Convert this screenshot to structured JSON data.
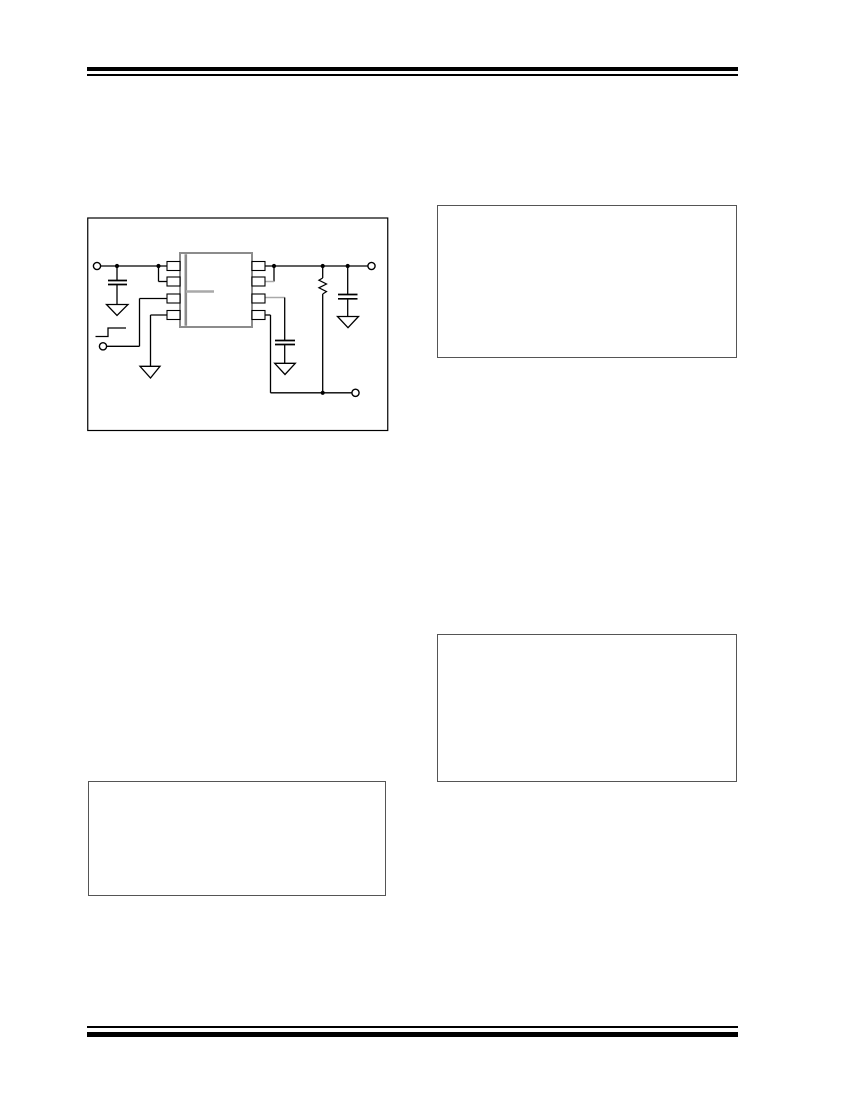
{
  "page": {
    "width": 849,
    "height": 1099,
    "background": "#ffffff"
  },
  "header_rule": {
    "color": "#000000",
    "thick": {
      "x": 87,
      "y": 66.5,
      "w": 651,
      "h": 4.6
    },
    "thin": {
      "x": 87,
      "y": 74.2,
      "w": 651,
      "h": 1.7
    }
  },
  "footer_rule": {
    "color": "#000000",
    "thin": {
      "x": 87,
      "y": 1026.3,
      "w": 651,
      "h": 1.7
    },
    "thick": {
      "x": 87,
      "y": 1031.6,
      "w": 651,
      "h": 5
    }
  },
  "placeholder_boxes": [
    {
      "name": "placeholder-box-top-right",
      "x": 437,
      "y": 205,
      "w": 300,
      "h": 153,
      "border_color": "#555555",
      "border_w": 1.6
    },
    {
      "name": "placeholder-box-middle-right",
      "x": 437,
      "y": 634,
      "w": 300,
      "h": 148,
      "border_color": "#555555",
      "border_w": 1.6
    },
    {
      "name": "placeholder-box-bottom-left",
      "x": 88,
      "y": 781,
      "w": 298,
      "h": 115,
      "border_color": "#555555",
      "border_w": 1.6
    }
  ],
  "figure": {
    "name": "typical-application-circuit",
    "frame": {
      "x": 87,
      "y": 217,
      "w": 302,
      "h": 215
    },
    "colors": {
      "line": "#000000",
      "ic": "#8c8c8c",
      "ghost": "#a9a9a9",
      "fill": "#ffffff"
    },
    "primitives": [
      {
        "n": "figure-frame",
        "t": "rect",
        "x": 0.75,
        "y": 1,
        "w": 300,
        "h": 212.5,
        "stroke": "line",
        "sw": 1.2,
        "fill": "none"
      },
      {
        "n": "wire-input",
        "t": "line",
        "x1": 13.6,
        "y1": 49,
        "x2": 80.6,
        "y2": 49,
        "stroke": "line",
        "sw": 1.3
      },
      {
        "n": "wire-pin2-horizontal",
        "t": "line",
        "x1": 71.5,
        "y1": 64.5,
        "x2": 80.6,
        "y2": 64.5,
        "stroke": "line",
        "sw": 1.3
      },
      {
        "n": "wire-pin2-vertical",
        "t": "line",
        "x1": 71.5,
        "y1": 49,
        "x2": 71.5,
        "y2": 64.5,
        "stroke": "line",
        "sw": 1.3
      },
      {
        "n": "wire-cin-upper-lead",
        "t": "line",
        "x1": 30,
        "y1": 49,
        "x2": 30,
        "y2": 63.5,
        "stroke": "line",
        "sw": 1.3
      },
      {
        "n": "wire-cin-lower-lead",
        "t": "line",
        "x1": 30,
        "y1": 67.5,
        "x2": 30,
        "y2": 87.5,
        "stroke": "line",
        "sw": 1.3
      },
      {
        "n": "wire-pin3-horizontal",
        "t": "line",
        "x1": 52.5,
        "y1": 81.5,
        "x2": 80.6,
        "y2": 81.5,
        "stroke": "line",
        "sw": 1.3
      },
      {
        "n": "wire-pin3-vertical",
        "t": "line",
        "x1": 52.5,
        "y1": 81.5,
        "x2": 52.5,
        "y2": 129.3,
        "stroke": "line",
        "sw": 1.3
      },
      {
        "n": "wire-enable",
        "t": "line",
        "x1": 19.6,
        "y1": 129.3,
        "x2": 52.5,
        "y2": 129.3,
        "stroke": "line",
        "sw": 1.3
      },
      {
        "n": "wire-pin4-horizontal",
        "t": "line",
        "x1": 63.5,
        "y1": 98,
        "x2": 80.6,
        "y2": 98,
        "stroke": "line",
        "sw": 1.3
      },
      {
        "n": "wire-pin4-vertical",
        "t": "line",
        "x1": 63.5,
        "y1": 98,
        "x2": 63.5,
        "y2": 149.3,
        "stroke": "line",
        "sw": 1.3
      },
      {
        "n": "wire-output",
        "t": "line",
        "x1": 177.4,
        "y1": 49,
        "x2": 280.9,
        "y2": 49,
        "stroke": "line",
        "sw": 1.3
      },
      {
        "n": "wire-pin7-vertical",
        "t": "line",
        "x1": 187,
        "y1": 49,
        "x2": 187,
        "y2": 64.5,
        "stroke": "line",
        "sw": 1.3
      },
      {
        "n": "wire-pin7-horizontal",
        "t": "line",
        "x1": 177.4,
        "y1": 64.5,
        "x2": 187,
        "y2": 64.5,
        "stroke": "ghost",
        "sw": 1.5
      },
      {
        "n": "wire-pin6-horizontal",
        "t": "line",
        "x1": 177.4,
        "y1": 80.5,
        "x2": 197.7,
        "y2": 80.5,
        "stroke": "ghost",
        "sw": 1.5
      },
      {
        "n": "wire-pin6-vertical",
        "t": "line",
        "x1": 197.7,
        "y1": 80.5,
        "x2": 197.7,
        "y2": 123.5,
        "stroke": "line",
        "sw": 1.3
      },
      {
        "n": "wire-cbyp-lower-lead",
        "t": "line",
        "x1": 197.7,
        "y1": 127.5,
        "x2": 197.7,
        "y2": 146.3,
        "stroke": "line",
        "sw": 1.3
      },
      {
        "n": "wire-pin5-horizontal",
        "t": "line",
        "x1": 177.4,
        "y1": 98,
        "x2": 183.5,
        "y2": 98,
        "stroke": "line",
        "sw": 1.3
      },
      {
        "n": "wire-pin5-vertical",
        "t": "line",
        "x1": 183.5,
        "y1": 98,
        "x2": 183.5,
        "y2": 175.8,
        "stroke": "line",
        "sw": 1.3
      },
      {
        "n": "wire-sense-bottom",
        "t": "line",
        "x1": 183.5,
        "y1": 175.8,
        "x2": 264.9,
        "y2": 175.8,
        "stroke": "line",
        "sw": 1.3
      },
      {
        "n": "wire-resistor-upper-lead",
        "t": "line",
        "x1": 235.7,
        "y1": 49,
        "x2": 235.7,
        "y2": 61,
        "stroke": "line",
        "sw": 1.3
      },
      {
        "n": "wire-resistor-lower-lead",
        "t": "line",
        "x1": 235.7,
        "y1": 77,
        "x2": 235.7,
        "y2": 175.8,
        "stroke": "line",
        "sw": 1.3
      },
      {
        "n": "wire-cout-upper-lead",
        "t": "line",
        "x1": 260.7,
        "y1": 49,
        "x2": 260.7,
        "y2": 77.5,
        "stroke": "line",
        "sw": 1.3
      },
      {
        "n": "wire-cout-lower-lead",
        "t": "line",
        "x1": 260.7,
        "y1": 81.8,
        "x2": 260.7,
        "y2": 99.5,
        "stroke": "line",
        "sw": 1.3
      },
      {
        "n": "step-input-symbol",
        "t": "poly",
        "closed": false,
        "pts": [
          [
            8.5,
            119.5
          ],
          [
            21,
            119.5
          ],
          [
            21,
            111
          ],
          [
            39,
            111
          ]
        ],
        "stroke": "line",
        "sw": 1.3,
        "fill": "none"
      },
      {
        "n": "resistor-zigzag",
        "t": "poly",
        "closed": false,
        "pts": [
          [
            235.7,
            61
          ],
          [
            231.9,
            63.2
          ],
          [
            239.5,
            67
          ],
          [
            231.9,
            70.8
          ],
          [
            239.5,
            74.6
          ],
          [
            235.7,
            77
          ]
        ],
        "stroke": "line",
        "sw": 1.2,
        "fill": "none"
      },
      {
        "n": "cin-plate-top",
        "t": "line",
        "x1": 21,
        "y1": 63.5,
        "x2": 40,
        "y2": 63.5,
        "stroke": "line",
        "sw": 1.7
      },
      {
        "n": "cin-plate-bottom",
        "t": "line",
        "x1": 21,
        "y1": 67.5,
        "x2": 40,
        "y2": 67.5,
        "stroke": "line",
        "sw": 1.7
      },
      {
        "n": "cout-plate-top",
        "t": "line",
        "x1": 251,
        "y1": 77.5,
        "x2": 270.5,
        "y2": 77.5,
        "stroke": "line",
        "sw": 1.7
      },
      {
        "n": "cout-plate-bottom",
        "t": "line",
        "x1": 251,
        "y1": 81.8,
        "x2": 270.5,
        "y2": 81.8,
        "stroke": "line",
        "sw": 1.7
      },
      {
        "n": "cbyp-plate-top",
        "t": "line",
        "x1": 188,
        "y1": 123.5,
        "x2": 208,
        "y2": 123.5,
        "stroke": "line",
        "sw": 1.7
      },
      {
        "n": "cbyp-plate-bottom",
        "t": "line",
        "x1": 188,
        "y1": 127.5,
        "x2": 208,
        "y2": 127.5,
        "stroke": "line",
        "sw": 1.7
      },
      {
        "n": "ground-symbol-input",
        "t": "poly",
        "closed": true,
        "pts": [
          [
            19.5,
            87.5
          ],
          [
            41,
            87.5
          ],
          [
            30,
            98.5
          ]
        ],
        "stroke": "line",
        "sw": 1.3,
        "fill": "fill"
      },
      {
        "n": "ground-symbol-output",
        "t": "poly",
        "closed": true,
        "pts": [
          [
            250.5,
            99.5
          ],
          [
            271.5,
            99.5
          ],
          [
            261,
            110.7
          ]
        ],
        "stroke": "line",
        "sw": 1.3,
        "fill": "fill"
      },
      {
        "n": "ground-symbol-bypass",
        "t": "poly",
        "closed": true,
        "pts": [
          [
            187.7,
            146.3
          ],
          [
            208.3,
            146.3
          ],
          [
            198,
            157.5
          ]
        ],
        "stroke": "line",
        "sw": 1.3,
        "fill": "fill"
      },
      {
        "n": "ground-symbol-gnd-pin",
        "t": "poly",
        "closed": true,
        "pts": [
          [
            53,
            149.3
          ],
          [
            73,
            149.3
          ],
          [
            63.5,
            161
          ]
        ],
        "stroke": "line",
        "sw": 1.3,
        "fill": "fill"
      },
      {
        "n": "ic-body",
        "t": "rect",
        "x": 93,
        "y": 36,
        "w": 72,
        "h": 74,
        "stroke": "ic",
        "sw": 2,
        "fill": "fill"
      },
      {
        "n": "ic-pin1-edge-bar",
        "t": "line",
        "x1": 98.8,
        "y1": 37.2,
        "x2": 98.8,
        "y2": 108.8,
        "stroke": "ic",
        "sw": 2.6
      },
      {
        "n": "ic-label-ghost",
        "t": "line",
        "x1": 99,
        "y1": 74.5,
        "x2": 127,
        "y2": 74.5,
        "stroke": "ghost",
        "sw": 2.6
      },
      {
        "n": "ic-pin-1",
        "t": "rect",
        "x": 80,
        "y": 44.5,
        "w": 13,
        "h": 9,
        "stroke": "line",
        "sw": 1.1,
        "fill": "fill"
      },
      {
        "n": "ic-pin-2",
        "t": "rect",
        "x": 80,
        "y": 60,
        "w": 13,
        "h": 9,
        "stroke": "line",
        "sw": 1.1,
        "fill": "fill"
      },
      {
        "n": "ic-pin-3",
        "t": "rect",
        "x": 80,
        "y": 77,
        "w": 13,
        "h": 9,
        "stroke": "line",
        "sw": 1.1,
        "fill": "fill"
      },
      {
        "n": "ic-pin-4",
        "t": "rect",
        "x": 80,
        "y": 93.5,
        "w": 13,
        "h": 9,
        "stroke": "line",
        "sw": 1.1,
        "fill": "fill"
      },
      {
        "n": "ic-pin-5",
        "t": "rect",
        "x": 165,
        "y": 93.5,
        "w": 13,
        "h": 9,
        "stroke": "line",
        "sw": 1.1,
        "fill": "fill"
      },
      {
        "n": "ic-pin-6",
        "t": "rect",
        "x": 165,
        "y": 77,
        "w": 13,
        "h": 9,
        "stroke": "line",
        "sw": 1.1,
        "fill": "fill"
      },
      {
        "n": "ic-pin-7",
        "t": "rect",
        "x": 165,
        "y": 60,
        "w": 13,
        "h": 9,
        "stroke": "line",
        "sw": 1.1,
        "fill": "fill"
      },
      {
        "n": "ic-pin-8",
        "t": "rect",
        "x": 165,
        "y": 44.5,
        "w": 13,
        "h": 9,
        "stroke": "line",
        "sw": 1.1,
        "fill": "fill"
      },
      {
        "n": "junction-dot",
        "t": "dot",
        "cx": 30,
        "cy": 49,
        "r": 2.1
      },
      {
        "n": "junction-dot",
        "t": "dot",
        "cx": 71.5,
        "cy": 49,
        "r": 2.1
      },
      {
        "n": "junction-dot",
        "t": "dot",
        "cx": 187,
        "cy": 49,
        "r": 2.1
      },
      {
        "n": "junction-dot",
        "t": "dot",
        "cx": 235.7,
        "cy": 49,
        "r": 2.1
      },
      {
        "n": "junction-dot",
        "t": "dot",
        "cx": 260.7,
        "cy": 49,
        "r": 2.1
      },
      {
        "n": "junction-dot",
        "t": "dot",
        "cx": 235.7,
        "cy": 175.8,
        "r": 2.1
      },
      {
        "n": "input-terminal",
        "t": "ring",
        "cx": 10,
        "cy": 49,
        "r": 3.6,
        "sw": 1.4
      },
      {
        "n": "enable-terminal",
        "t": "ring",
        "cx": 16,
        "cy": 129.3,
        "r": 3.6,
        "sw": 1.4
      },
      {
        "n": "output-terminal",
        "t": "ring",
        "cx": 284.5,
        "cy": 49,
        "r": 3.6,
        "sw": 1.4
      },
      {
        "n": "sense-terminal",
        "t": "ring",
        "cx": 268.5,
        "cy": 175.8,
        "r": 3.6,
        "sw": 1.4
      }
    ]
  }
}
